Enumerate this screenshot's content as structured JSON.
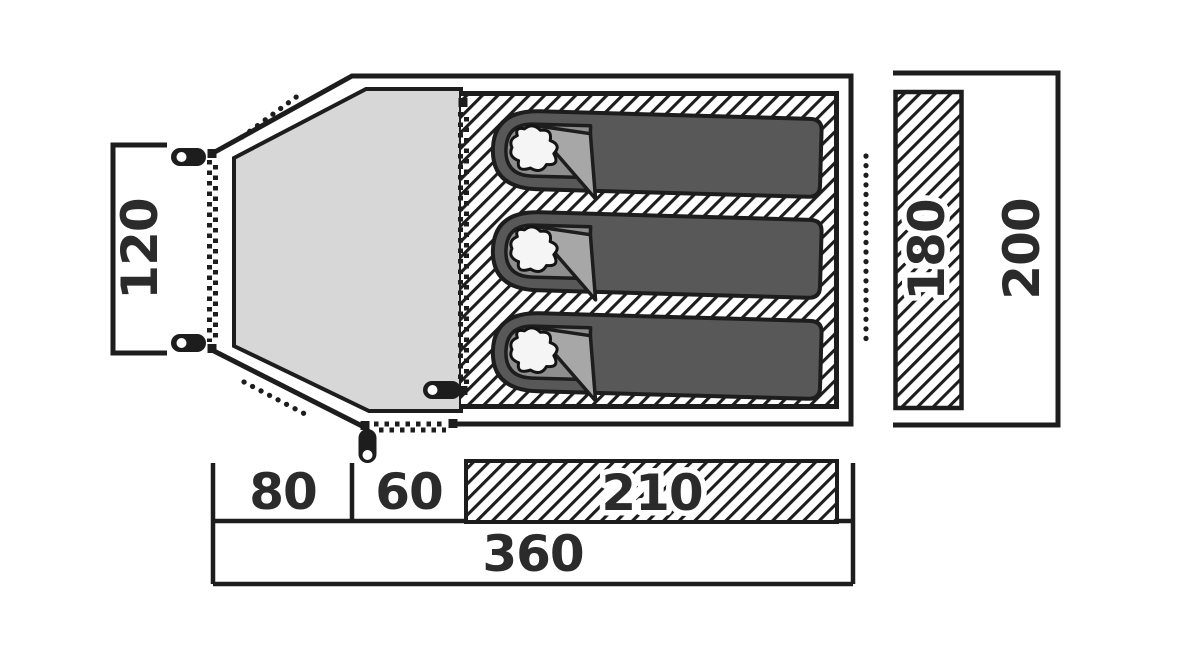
{
  "labels": {
    "porch_opening": "120",
    "inner_width": "180",
    "total_width": "200",
    "porch_depth": "80",
    "door_depth": "60",
    "inner_length": "210",
    "total_length": "360"
  },
  "colors": {
    "background": "#ffffff",
    "outline": "#1d1d1d",
    "porch_floor": "#d7d7d7",
    "bag_body": "#585858",
    "bag_opening": "#8e8e8e",
    "bag_flap": "#a7a7a7",
    "pillow": "#f5f5f5",
    "label_text": "#2b2b2b"
  }
}
